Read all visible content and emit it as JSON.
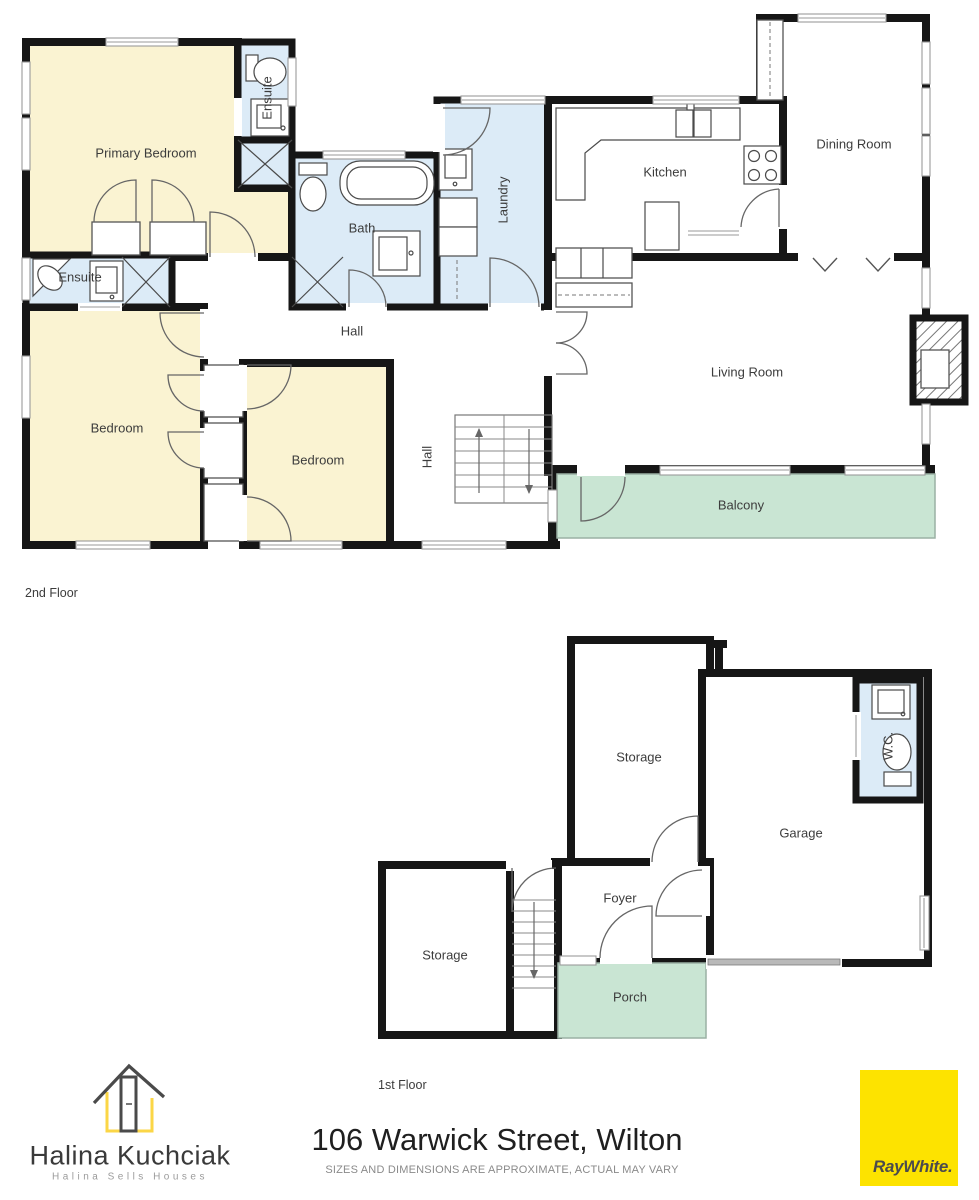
{
  "title": "Floor plan - 106 Warwick Street, Wilton",
  "colors": {
    "wall": "#161616",
    "room_yellow": "#faf3d2",
    "room_blue": "#dcebf7",
    "room_green": "#c9e5d3",
    "window_line": "#9a9a9a",
    "fixture": "#4a4a4a",
    "label_text": "#3c3c3c",
    "brand_yellow": "#fde300",
    "logo_yellow": "#fbd646",
    "logo_dark": "#4a4a4a"
  },
  "floors": [
    {
      "floor_label": {
        "text": "2nd Floor",
        "x": 25,
        "y": 586
      },
      "rooms": [
        {
          "label": "Primary Bedroom",
          "x": 146,
          "y": 153,
          "vertical": false
        },
        {
          "label": "Ensuite",
          "x": 267,
          "y": 98,
          "vertical": true
        },
        {
          "label": "Ensuite",
          "x": 80,
          "y": 277,
          "vertical": false
        },
        {
          "label": "Bath",
          "x": 362,
          "y": 228,
          "vertical": false
        },
        {
          "label": "Laundry",
          "x": 503,
          "y": 200,
          "vertical": true
        },
        {
          "label": "Kitchen",
          "x": 665,
          "y": 172,
          "vertical": false
        },
        {
          "label": "Dining Room",
          "x": 854,
          "y": 144,
          "vertical": false
        },
        {
          "label": "Living Room",
          "x": 747,
          "y": 372,
          "vertical": false
        },
        {
          "label": "Hall",
          "x": 352,
          "y": 331,
          "vertical": false
        },
        {
          "label": "Hall",
          "x": 427,
          "y": 457,
          "vertical": true
        },
        {
          "label": "Bedroom",
          "x": 117,
          "y": 428,
          "vertical": false
        },
        {
          "label": "Bedroom",
          "x": 318,
          "y": 460,
          "vertical": false
        },
        {
          "label": "Balcony",
          "x": 741,
          "y": 505,
          "vertical": false
        }
      ]
    },
    {
      "floor_label": {
        "text": "1st Floor",
        "x": 378,
        "y": 1078
      },
      "rooms": [
        {
          "label": "Storage",
          "x": 639,
          "y": 757,
          "vertical": false
        },
        {
          "label": "W.C.",
          "x": 888,
          "y": 746,
          "vertical": true
        },
        {
          "label": "Garage",
          "x": 801,
          "y": 833,
          "vertical": false
        },
        {
          "label": "Foyer",
          "x": 620,
          "y": 898,
          "vertical": false
        },
        {
          "label": "Storage",
          "x": 445,
          "y": 955,
          "vertical": false
        },
        {
          "label": "Porch",
          "x": 630,
          "y": 997,
          "vertical": false
        }
      ]
    }
  ],
  "footer": {
    "agent_name": "Halina Kuchciak",
    "agent_tagline": "Halina Sells Houses",
    "address": "106 Warwick Street, Wilton",
    "disclaimer": "SIZES AND DIMENSIONS ARE APPROXIMATE, ACTUAL MAY VARY",
    "brand": "RayWhite."
  }
}
